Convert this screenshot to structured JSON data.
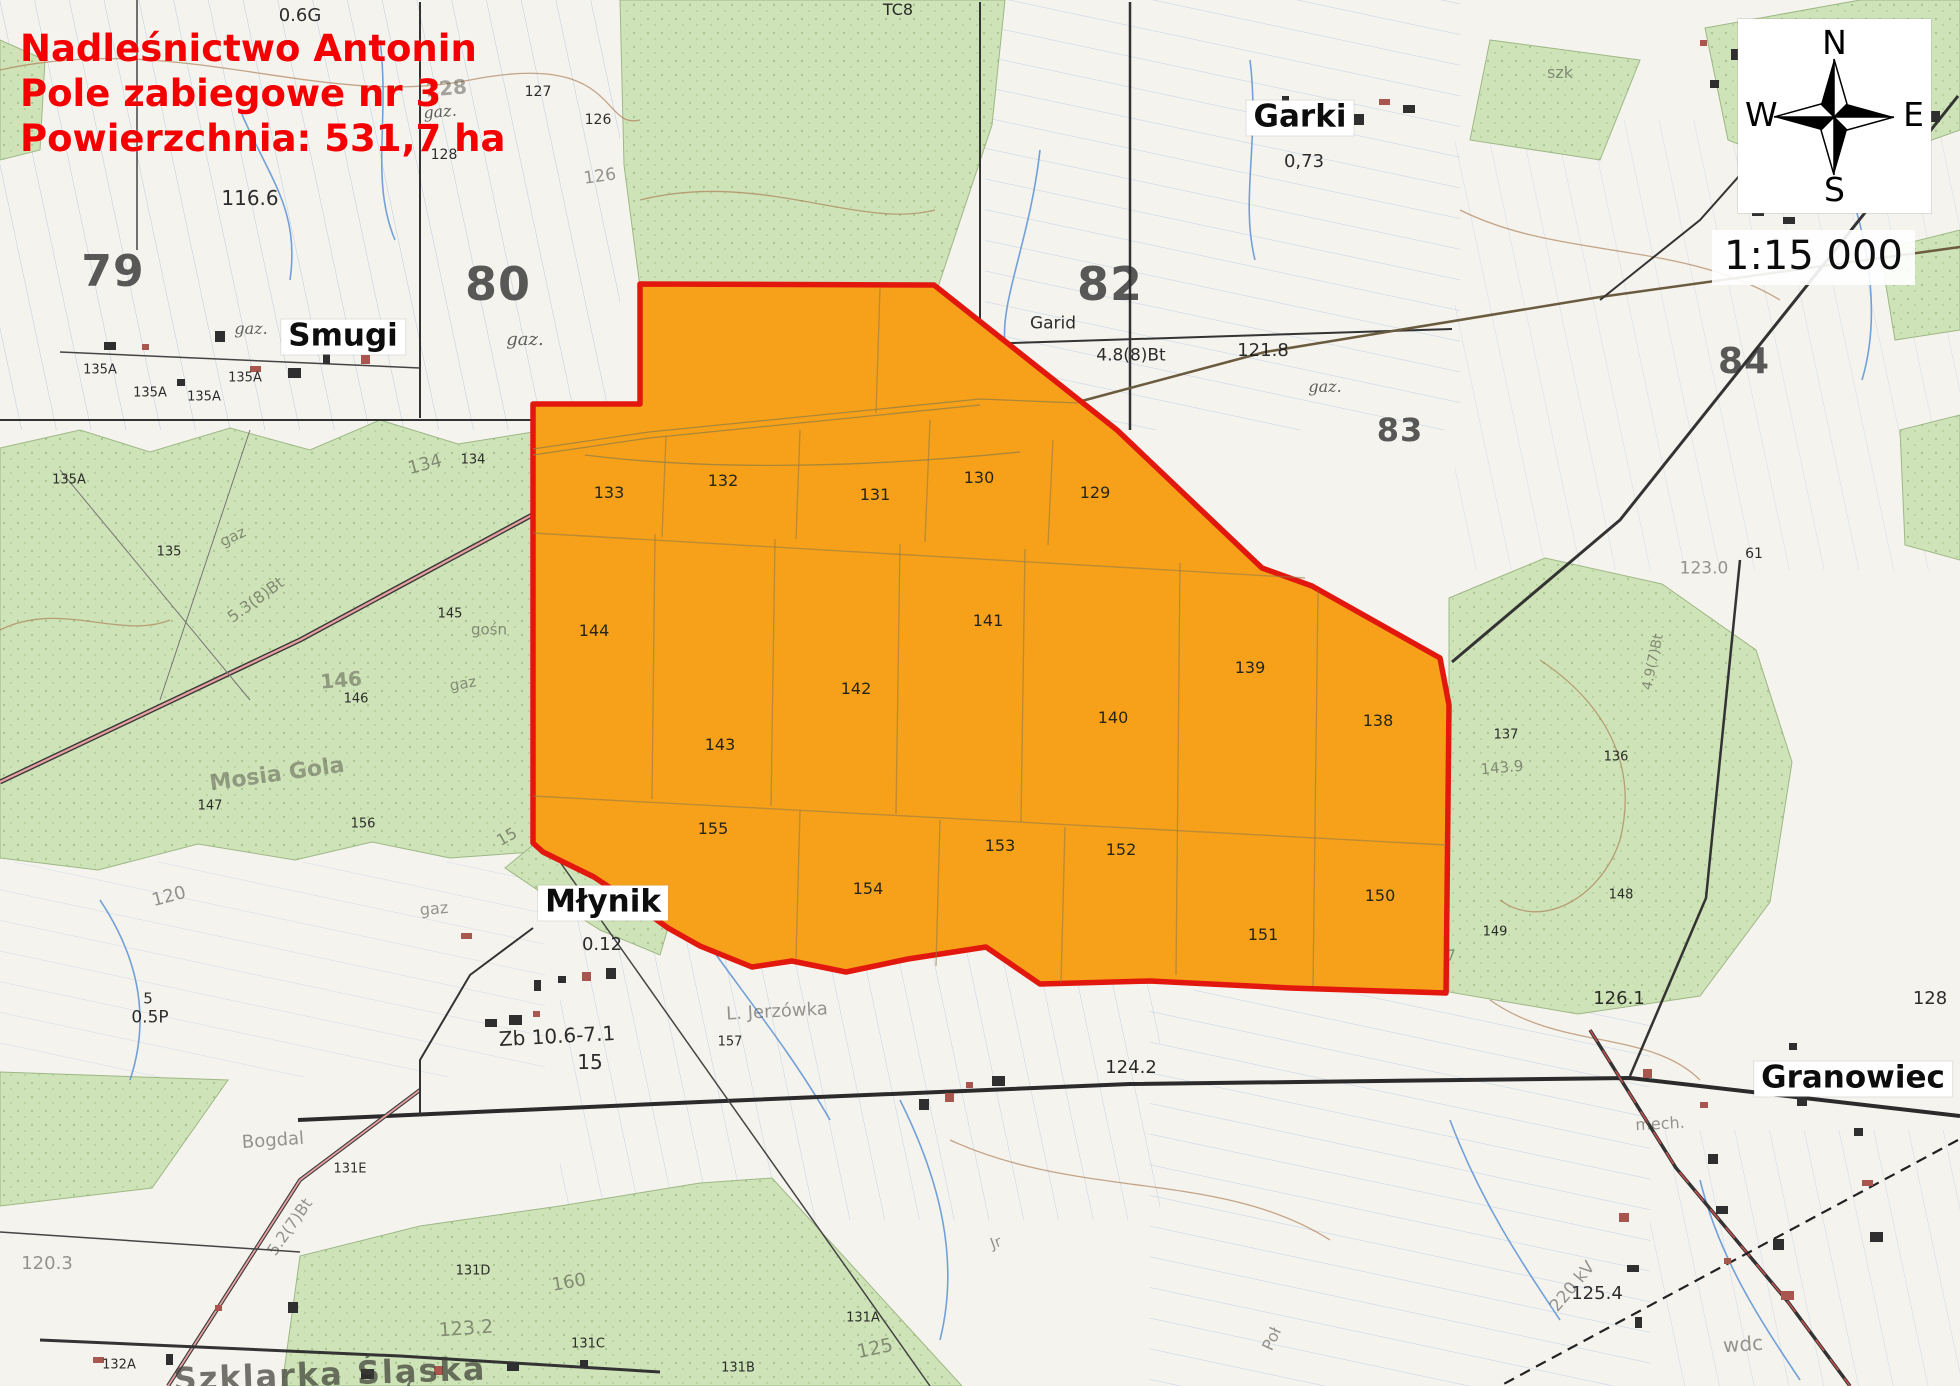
{
  "title_block": {
    "line1": "Nadleśnictwo Antonin",
    "line2": "Pole zabiegowe nr 3",
    "line3": "Powierzchnia: 531,7 ha"
  },
  "scale_text": "1:15 000",
  "compass": {
    "n": "N",
    "e": "E",
    "s": "S",
    "w": "W"
  },
  "colors": {
    "field_fill": "#F7A11B",
    "field_border": "#E2180E",
    "forest_green": "#CFE3B8",
    "water_blue": "#5B92D5",
    "title_red": "#F40000"
  },
  "field": {
    "label": "Pole zabiegowe nr 3",
    "outline": [
      [
        640,
        284
      ],
      [
        934,
        285
      ],
      [
        1117,
        430
      ],
      [
        1262,
        568
      ],
      [
        1312,
        586
      ],
      [
        1440,
        658
      ],
      [
        1449,
        705
      ],
      [
        1446,
        993
      ],
      [
        1290,
        988
      ],
      [
        1150,
        981
      ],
      [
        1040,
        984
      ],
      [
        986,
        947
      ],
      [
        908,
        959
      ],
      [
        846,
        972
      ],
      [
        792,
        961
      ],
      [
        752,
        967
      ],
      [
        700,
        946
      ],
      [
        668,
        928
      ],
      [
        636,
        905
      ],
      [
        594,
        877
      ],
      [
        543,
        852
      ],
      [
        533,
        843
      ],
      [
        533,
        404
      ],
      [
        640,
        404
      ]
    ],
    "grid": [
      [
        [
          880,
          288
        ],
        [
          876,
          413
        ]
      ],
      [
        [
          666,
          436
        ],
        [
          662,
          537
        ]
      ],
      [
        [
          800,
          430
        ],
        [
          796,
          539
        ]
      ],
      [
        [
          930,
          420
        ],
        [
          925,
          542
        ]
      ],
      [
        [
          1053,
          440
        ],
        [
          1048,
          545
        ]
      ],
      [
        [
          533,
          533
        ],
        [
          1305,
          578
        ]
      ],
      [
        [
          655,
          534
        ],
        [
          652,
          799
        ]
      ],
      [
        [
          775,
          539
        ],
        [
          771,
          806
        ]
      ],
      [
        [
          900,
          544
        ],
        [
          896,
          814
        ]
      ],
      [
        [
          1025,
          549
        ],
        [
          1021,
          822
        ]
      ],
      [
        [
          1180,
          563
        ],
        [
          1176,
          975
        ]
      ],
      [
        [
          1318,
          590
        ],
        [
          1313,
          986
        ]
      ],
      [
        [
          533,
          796
        ],
        [
          1446,
          845
        ]
      ],
      [
        [
          800,
          811
        ],
        [
          796,
          958
        ]
      ],
      [
        [
          940,
          820
        ],
        [
          936,
          966
        ]
      ],
      [
        [
          1065,
          827
        ],
        [
          1061,
          983
        ]
      ]
    ],
    "compartments": [
      {
        "id": "133",
        "x": 609,
        "y": 493
      },
      {
        "id": "132",
        "x": 723,
        "y": 481
      },
      {
        "id": "131",
        "x": 875,
        "y": 495
      },
      {
        "id": "130",
        "x": 979,
        "y": 478
      },
      {
        "id": "129",
        "x": 1095,
        "y": 493
      },
      {
        "id": "144",
        "x": 594,
        "y": 631
      },
      {
        "id": "141",
        "x": 988,
        "y": 621
      },
      {
        "id": "142",
        "x": 856,
        "y": 689
      },
      {
        "id": "143",
        "x": 720,
        "y": 745
      },
      {
        "id": "140",
        "x": 1113,
        "y": 718
      },
      {
        "id": "139",
        "x": 1250,
        "y": 668
      },
      {
        "id": "138",
        "x": 1378,
        "y": 721
      },
      {
        "id": "155",
        "x": 713,
        "y": 829
      },
      {
        "id": "153",
        "x": 1000,
        "y": 846
      },
      {
        "id": "152",
        "x": 1121,
        "y": 850
      },
      {
        "id": "154",
        "x": 868,
        "y": 889
      },
      {
        "id": "151",
        "x": 1263,
        "y": 935
      },
      {
        "id": "150",
        "x": 1380,
        "y": 896
      }
    ]
  },
  "places": [
    {
      "name": "Garki",
      "x": 1300,
      "y": 118
    },
    {
      "name": "Smugi",
      "x": 343,
      "y": 337
    },
    {
      "name": "Młynik",
      "x": 603,
      "y": 903
    },
    {
      "name": "Granowiec",
      "x": 1853,
      "y": 1079
    }
  ],
  "big_numbers": [
    {
      "text": "79",
      "x": 113,
      "y": 272,
      "fs": 44
    },
    {
      "text": "80",
      "x": 498,
      "y": 284,
      "fs": 46
    },
    {
      "text": "82",
      "x": 1110,
      "y": 284,
      "fs": 46
    },
    {
      "text": "83",
      "x": 1400,
      "y": 430,
      "fs": 32
    },
    {
      "text": "84",
      "x": 1744,
      "y": 362,
      "fs": 36
    }
  ],
  "map_labels": [
    {
      "text": "0.6G",
      "x": 300,
      "y": 16,
      "fs": 18,
      "rot": 0,
      "cls": "md"
    },
    {
      "text": "TC8",
      "x": 898,
      "y": 10,
      "fs": 16,
      "rot": 0,
      "cls": "md"
    },
    {
      "text": "szk",
      "x": 1560,
      "y": 73,
      "fs": 16,
      "rot": 0,
      "cls": "fade"
    },
    {
      "text": "128",
      "x": 446,
      "y": 88,
      "fs": 20,
      "rot": -5,
      "cls": "fadeb"
    },
    {
      "text": "127",
      "x": 538,
      "y": 92,
      "fs": 14,
      "rot": 0,
      "cls": "sm"
    },
    {
      "text": "126",
      "x": 598,
      "y": 120,
      "fs": 14,
      "rot": 0,
      "cls": "sm"
    },
    {
      "text": "gaz.",
      "x": 440,
      "y": 112,
      "fs": 16,
      "rot": -5,
      "cls": "ital"
    },
    {
      "text": "128",
      "x": 444,
      "y": 155,
      "fs": 14,
      "rot": 0,
      "cls": "sm"
    },
    {
      "text": "126",
      "x": 600,
      "y": 177,
      "fs": 17,
      "rot": -8,
      "cls": "fade"
    },
    {
      "text": "0,73",
      "x": 1304,
      "y": 162,
      "fs": 18,
      "rot": 0,
      "cls": "md"
    },
    {
      "text": "116.6",
      "x": 250,
      "y": 198,
      "fs": 20,
      "rot": 0,
      "cls": "md"
    },
    {
      "text": "gaz.",
      "x": 251,
      "y": 329,
      "fs": 16,
      "rot": 0,
      "cls": "ital"
    },
    {
      "text": "gaz.",
      "x": 525,
      "y": 340,
      "fs": 18,
      "rot": 0,
      "cls": "ital"
    },
    {
      "text": "Garid",
      "x": 1053,
      "y": 324,
      "fs": 17,
      "rot": 0,
      "cls": "md"
    },
    {
      "text": "4.8(8)Bt",
      "x": 1131,
      "y": 356,
      "fs": 17,
      "rot": 0,
      "cls": "md"
    },
    {
      "text": "121.8",
      "x": 1263,
      "y": 351,
      "fs": 18,
      "rot": 0,
      "cls": "md"
    },
    {
      "text": "gaz.",
      "x": 1325,
      "y": 387,
      "fs": 16,
      "rot": 0,
      "cls": "ital"
    },
    {
      "text": "135A",
      "x": 100,
      "y": 370,
      "fs": 13,
      "rot": 0,
      "cls": "sm"
    },
    {
      "text": "135A",
      "x": 245,
      "y": 378,
      "fs": 13,
      "rot": 0,
      "cls": "sm"
    },
    {
      "text": "135A",
      "x": 150,
      "y": 393,
      "fs": 13,
      "rot": 0,
      "cls": "sm"
    },
    {
      "text": "135A",
      "x": 204,
      "y": 397,
      "fs": 13,
      "rot": 0,
      "cls": "sm"
    },
    {
      "text": "135A",
      "x": 69,
      "y": 480,
      "fs": 13,
      "rot": 0,
      "cls": "sm"
    },
    {
      "text": "134",
      "x": 425,
      "y": 465,
      "fs": 18,
      "rot": -15,
      "cls": "fade"
    },
    {
      "text": "134",
      "x": 473,
      "y": 460,
      "fs": 13,
      "rot": 0,
      "cls": "sm"
    },
    {
      "text": "135",
      "x": 169,
      "y": 552,
      "fs": 13,
      "rot": 0,
      "cls": "sm"
    },
    {
      "text": "gaz",
      "x": 233,
      "y": 537,
      "fs": 15,
      "rot": -25,
      "cls": "fade"
    },
    {
      "text": "5.3(8)Bt",
      "x": 256,
      "y": 600,
      "fs": 16,
      "rot": -36,
      "cls": "fade"
    },
    {
      "text": "145",
      "x": 450,
      "y": 614,
      "fs": 13,
      "rot": 0,
      "cls": "sm"
    },
    {
      "text": "gośn",
      "x": 489,
      "y": 630,
      "fs": 15,
      "rot": 0,
      "cls": "fade"
    },
    {
      "text": "146",
      "x": 341,
      "y": 680,
      "fs": 20,
      "rot": -5,
      "cls": "fadeb"
    },
    {
      "text": "146",
      "x": 356,
      "y": 699,
      "fs": 13,
      "rot": 0,
      "cls": "sm"
    },
    {
      "text": "gaz",
      "x": 463,
      "y": 684,
      "fs": 15,
      "rot": -10,
      "cls": "fade"
    },
    {
      "text": "Mosia Gola",
      "x": 277,
      "y": 775,
      "fs": 22,
      "rot": -8,
      "cls": "fadeb"
    },
    {
      "text": "147",
      "x": 210,
      "y": 806,
      "fs": 13,
      "rot": 0,
      "cls": "sm"
    },
    {
      "text": "156",
      "x": 363,
      "y": 824,
      "fs": 13,
      "rot": 0,
      "cls": "sm"
    },
    {
      "text": "15",
      "x": 507,
      "y": 837,
      "fs": 16,
      "rot": -30,
      "cls": "fade"
    },
    {
      "text": "61",
      "x": 1754,
      "y": 554,
      "fs": 14,
      "rot": 0,
      "cls": "sm"
    },
    {
      "text": "123.0",
      "x": 1704,
      "y": 569,
      "fs": 17,
      "rot": 0,
      "cls": "fade"
    },
    {
      "text": "4.9(7)Bt",
      "x": 1653,
      "y": 662,
      "fs": 14,
      "rot": -78,
      "cls": "fade"
    },
    {
      "text": "143.9",
      "x": 1502,
      "y": 768,
      "fs": 15,
      "rot": -5,
      "cls": "fade"
    },
    {
      "text": "137",
      "x": 1506,
      "y": 735,
      "fs": 13,
      "rot": 0,
      "cls": "sm"
    },
    {
      "text": "136",
      "x": 1616,
      "y": 757,
      "fs": 13,
      "rot": 0,
      "cls": "sm"
    },
    {
      "text": "148",
      "x": 1621,
      "y": 895,
      "fs": 13,
      "rot": 0,
      "cls": "sm"
    },
    {
      "text": "149",
      "x": 1495,
      "y": 932,
      "fs": 13,
      "rot": 0,
      "cls": "sm"
    },
    {
      "text": "7",
      "x": 1451,
      "y": 956,
      "fs": 15,
      "rot": 0,
      "cls": "fade"
    },
    {
      "text": "126.1",
      "x": 1619,
      "y": 999,
      "fs": 18,
      "rot": 0,
      "cls": "md"
    },
    {
      "text": "128",
      "x": 1930,
      "y": 999,
      "fs": 18,
      "rot": 0,
      "cls": "md"
    },
    {
      "text": "mech.",
      "x": 1660,
      "y": 1124,
      "fs": 16,
      "rot": -3,
      "cls": "fade"
    },
    {
      "text": "125.4",
      "x": 1597,
      "y": 1294,
      "fs": 18,
      "rot": 0,
      "cls": "md"
    },
    {
      "text": "wdc",
      "x": 1743,
      "y": 1344,
      "fs": 20,
      "rot": -4,
      "cls": "fade"
    },
    {
      "text": "220 kV",
      "x": 1573,
      "y": 1287,
      "fs": 17,
      "rot": -50,
      "cls": "fade"
    },
    {
      "text": "Poł",
      "x": 1272,
      "y": 1339,
      "fs": 16,
      "rot": -65,
      "cls": "fade"
    },
    {
      "text": "Jr",
      "x": 996,
      "y": 1243,
      "fs": 15,
      "rot": -20,
      "cls": "fade"
    },
    {
      "text": "124.2",
      "x": 1131,
      "y": 1068,
      "fs": 18,
      "rot": 0,
      "cls": "md"
    },
    {
      "text": "131A",
      "x": 863,
      "y": 1318,
      "fs": 13,
      "rot": 0,
      "cls": "sm"
    },
    {
      "text": "125",
      "x": 875,
      "y": 1349,
      "fs": 19,
      "rot": -12,
      "cls": "fade"
    },
    {
      "text": "131B",
      "x": 738,
      "y": 1368,
      "fs": 13,
      "rot": 0,
      "cls": "sm"
    },
    {
      "text": "131C",
      "x": 588,
      "y": 1344,
      "fs": 13,
      "rot": 0,
      "cls": "sm"
    },
    {
      "text": "123.2",
      "x": 466,
      "y": 1329,
      "fs": 19,
      "rot": -4,
      "cls": "fade"
    },
    {
      "text": "160",
      "x": 569,
      "y": 1283,
      "fs": 18,
      "rot": -10,
      "cls": "fade"
    },
    {
      "text": "131D",
      "x": 473,
      "y": 1271,
      "fs": 13,
      "rot": 0,
      "cls": "sm"
    },
    {
      "text": "5.2(7)Bt",
      "x": 290,
      "y": 1227,
      "fs": 16,
      "rot": -55,
      "cls": "fade"
    },
    {
      "text": "131E",
      "x": 350,
      "y": 1169,
      "fs": 13,
      "rot": 0,
      "cls": "sm"
    },
    {
      "text": "Bogdal",
      "x": 273,
      "y": 1141,
      "fs": 18,
      "rot": -4,
      "cls": "fade"
    },
    {
      "text": "120.3",
      "x": 47,
      "y": 1264,
      "fs": 18,
      "rot": 0,
      "cls": "fade"
    },
    {
      "text": "132A",
      "x": 119,
      "y": 1365,
      "fs": 13,
      "rot": 0,
      "cls": "sm"
    },
    {
      "text": "Szklarka Śląska",
      "x": 330,
      "y": 1374,
      "fs": 32,
      "rot": -2,
      "cls": "fadebold"
    },
    {
      "text": "0.12",
      "x": 602,
      "y": 945,
      "fs": 18,
      "rot": 0,
      "cls": "md"
    },
    {
      "text": "Zb 10.6-7.1",
      "x": 557,
      "y": 1036,
      "fs": 20,
      "rot": -3,
      "cls": "md"
    },
    {
      "text": "15",
      "x": 590,
      "y": 1062,
      "fs": 20,
      "rot": 0,
      "cls": "md"
    },
    {
      "text": "L. Jerzówka",
      "x": 777,
      "y": 1012,
      "fs": 18,
      "rot": -3,
      "cls": "fade"
    },
    {
      "text": "157",
      "x": 730,
      "y": 1042,
      "fs": 13,
      "rot": 0,
      "cls": "sm"
    },
    {
      "text": "gaz",
      "x": 434,
      "y": 909,
      "fs": 16,
      "rot": -5,
      "cls": "fade"
    },
    {
      "text": "120",
      "x": 169,
      "y": 897,
      "fs": 18,
      "rot": -15,
      "cls": "fade"
    },
    {
      "text": "5",
      "x": 148,
      "y": 999,
      "fs": 15,
      "rot": 0,
      "cls": "md"
    },
    {
      "text": "0.5P",
      "x": 150,
      "y": 1018,
      "fs": 17,
      "rot": 0,
      "cls": "md"
    }
  ]
}
